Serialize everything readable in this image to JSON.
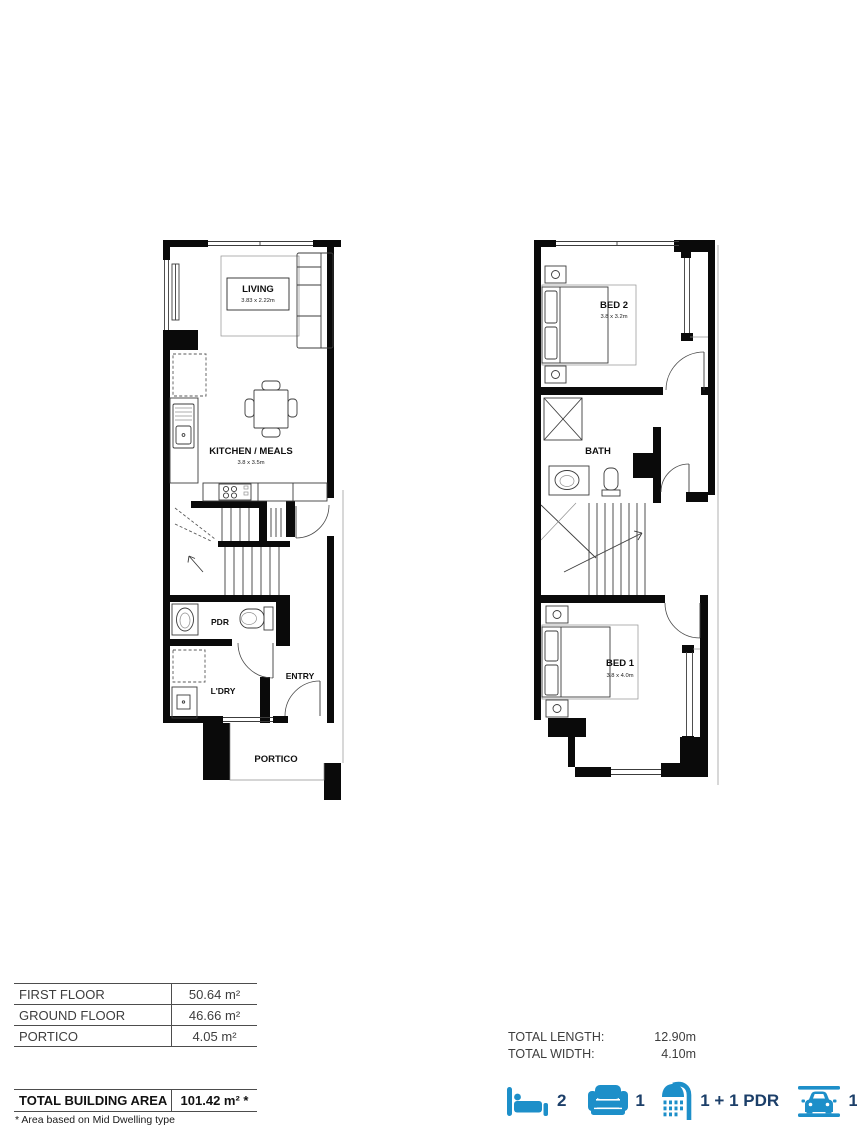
{
  "floor_plans": {
    "ground": {
      "living": {
        "label": "LIVING",
        "dims": "3.83 x 2.22m"
      },
      "kitchen_meals": {
        "label": "KITCHEN / MEALS",
        "dims": "3.8 x 3.5m"
      },
      "pdr": {
        "label": "PDR"
      },
      "ldry": {
        "label": "L'DRY"
      },
      "entry": {
        "label": "ENTRY"
      },
      "portico": {
        "label": "PORTICO"
      }
    },
    "first": {
      "bed2": {
        "label": "BED 2",
        "dims": "3.8 x 3.2m"
      },
      "bath": {
        "label": "BATH"
      },
      "bed1": {
        "label": "BED 1",
        "dims": "3.8 x 4.0m"
      }
    }
  },
  "area_table": {
    "rows": [
      {
        "label": "FIRST FLOOR",
        "value": "50.64 m²"
      },
      {
        "label": "GROUND FLOOR",
        "value": "46.66 m²"
      },
      {
        "label": "PORTICO",
        "value": "4.05 m²"
      }
    ],
    "total_label": "TOTAL BUILDING AREA",
    "total_value": "101.42 m² *",
    "footnote": "* Area based on Mid Dwelling type"
  },
  "totals": {
    "length_label": "TOTAL LENGTH:",
    "length_value": "12.90m",
    "width_label": "TOTAL WIDTH:",
    "width_value": "4.10m"
  },
  "features": {
    "bedrooms": {
      "icon": "bed-icon",
      "count": "2"
    },
    "living_areas": {
      "icon": "armchair-icon",
      "count": "1"
    },
    "bathrooms": {
      "icon": "shower-icon",
      "count": "1 + 1 PDR"
    },
    "garage": {
      "icon": "car-icon",
      "count": "1"
    }
  },
  "colors": {
    "icon_blue": "#1d8fc9",
    "count_navy": "#1c3f69",
    "walls": "#0a0a0a",
    "background": "#ffffff"
  }
}
